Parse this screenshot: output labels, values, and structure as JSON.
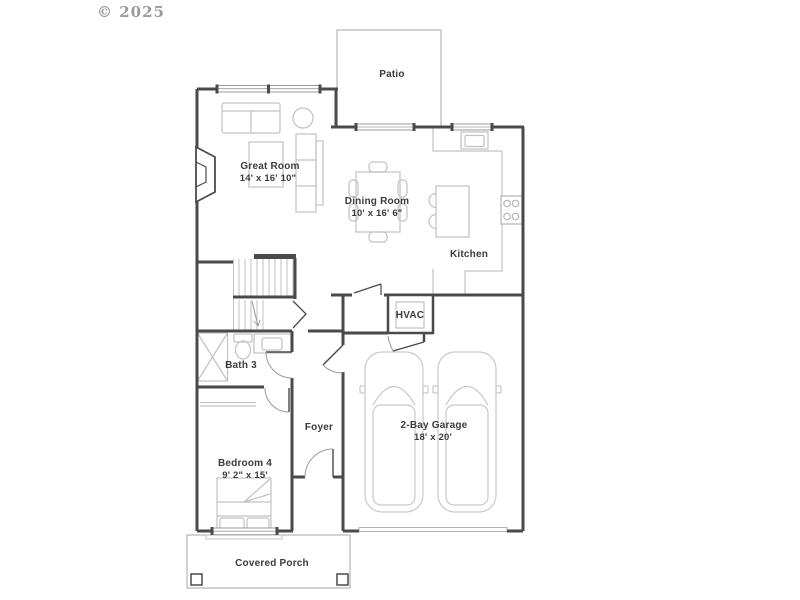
{
  "copyright": "© 2025",
  "colors": {
    "background": "#ffffff",
    "wall": "#4a4a4a",
    "furniture": "#c2c2c2",
    "light_outline": "#b3b3b3",
    "door_arc": "#9a9a9a",
    "text": "#3b3b3b",
    "copyright_text": "#9a9a9a"
  },
  "rooms": {
    "patio": {
      "name": "Patio"
    },
    "great_room": {
      "name": "Great Room",
      "dimensions": "14' x 16' 10\""
    },
    "dining_room": {
      "name": "Dining Room",
      "dimensions": "10' x 16' 6\""
    },
    "kitchen": {
      "name": "Kitchen"
    },
    "hvac": {
      "name": "HVAC"
    },
    "bath3": {
      "name": "Bath 3"
    },
    "foyer": {
      "name": "Foyer"
    },
    "bedroom4": {
      "name": "Bedroom 4",
      "dimensions": "9' 2\" x 15'"
    },
    "garage": {
      "name": "2-Bay Garage",
      "dimensions": "18' x 20'"
    },
    "covered_porch": {
      "name": "Covered Porch"
    }
  }
}
